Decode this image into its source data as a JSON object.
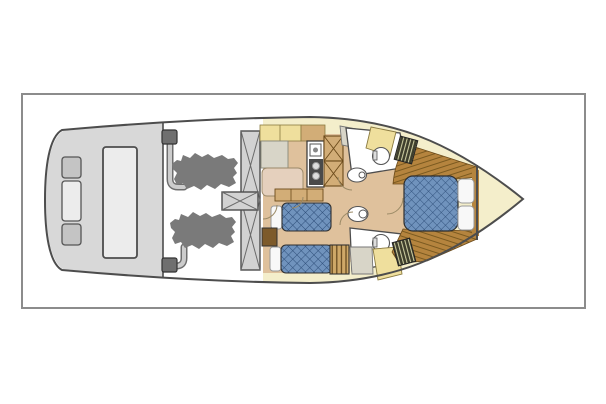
{
  "figure": {
    "kind": "yacht-floor-plan-top-view",
    "orientation": "bow-right",
    "engine_count": 2,
    "guest_berth_count": 2,
    "master_berth_count": 1,
    "head_count": 2
  },
  "colors": {
    "page_bg": "#ffffff",
    "frame_border": "#8c8c8c",
    "outline": "#4d4d4d",
    "hull_white": "#ffffff",
    "deck_gray": "#d8d8d8",
    "seat_gray": "#c4c4c4",
    "seat_light": "#ececec",
    "engine_gray": "#7a7a7a",
    "pipe_fill": "#cccccc",
    "pipe_stroke": "#6e6e6e",
    "exhaust_dark": "#6f6f6f",
    "hatch_gray": "#d2d2d2",
    "cream": "#f4eecb",
    "yellow": "#efdf9d",
    "tan_floor": "#dfc19c",
    "tan_mid": "#d2ad77",
    "tan_settee": "#e5d0bd",
    "pale_gray": "#d8d5c8",
    "wood": "#b5843e",
    "wood_line": "#7b5a20",
    "mattress_blue": "#7093bd",
    "mattress_line": "#30507b",
    "pillow_white": "#f8f8f8",
    "dark_hatch": "#3e3e2c",
    "dark_hatch_line": "#d6d6a8",
    "steps_tan": "#cfa868",
    "steps_line": "#5f431a",
    "nightstand_brown": "#7d5a2a",
    "fixture_white": "#ffffff",
    "wall": "#4d4d4d",
    "arc_line": "#9b8a66",
    "stove_dark": "#4a4a4a",
    "burner_light": "#dddddd"
  }
}
